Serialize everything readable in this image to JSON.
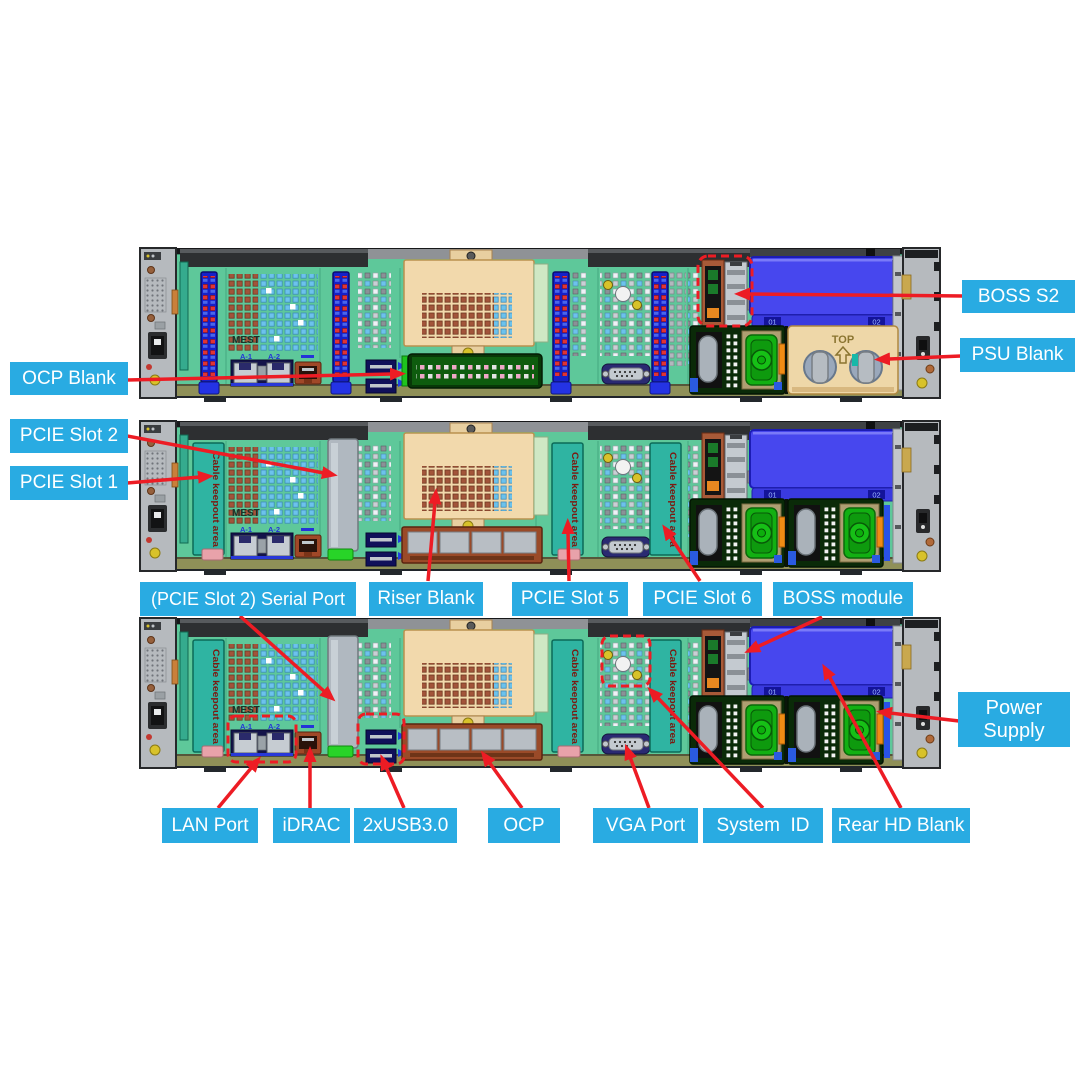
{
  "diagram": {
    "colors": {
      "label_bg": "#29abe2",
      "label_text": "#ffffff",
      "arrow_red": "#ed1c24",
      "chassis_green": "#5ec89a",
      "keepout_teal": "#2fb4a2",
      "riser_tan": "#f2d9ac",
      "hd_blank_blue": "#4747ee",
      "psu_fan_green": "#12b012",
      "psu_blank_tan": "#eed7a8",
      "end_cap_gray": "#b6babe"
    },
    "texts": {
      "mest": "MEST",
      "cable_keepout": "Cable keepout area",
      "psu_blank_top": "TOP",
      "lan_a1": "A-1",
      "lan_a2": "A-2",
      "hd01": "01",
      "hd02": "02"
    },
    "labels": {
      "boss_s2": "BOSS S2",
      "psu_blank": "PSU Blank",
      "ocp_blank": "OCP Blank",
      "pcie_slot_2": "PCIE Slot 2",
      "pcie_slot_1": "PCIE Slot 1",
      "serial_port": "(PCIE Slot 2) Serial Port",
      "riser_blank": "Riser Blank",
      "pcie_slot_5": "PCIE Slot 5",
      "pcie_slot_6": "PCIE Slot 6",
      "boss_module": "BOSS module",
      "power_supply": "Power Supply",
      "lan_port": "LAN Port",
      "idrac": "iDRAC",
      "usb": "2xUSB3.0",
      "ocp": "OCP",
      "vga_port": "VGA Port",
      "system_id": "System  ID",
      "rear_hd_blank": "Rear HD Blank"
    }
  }
}
